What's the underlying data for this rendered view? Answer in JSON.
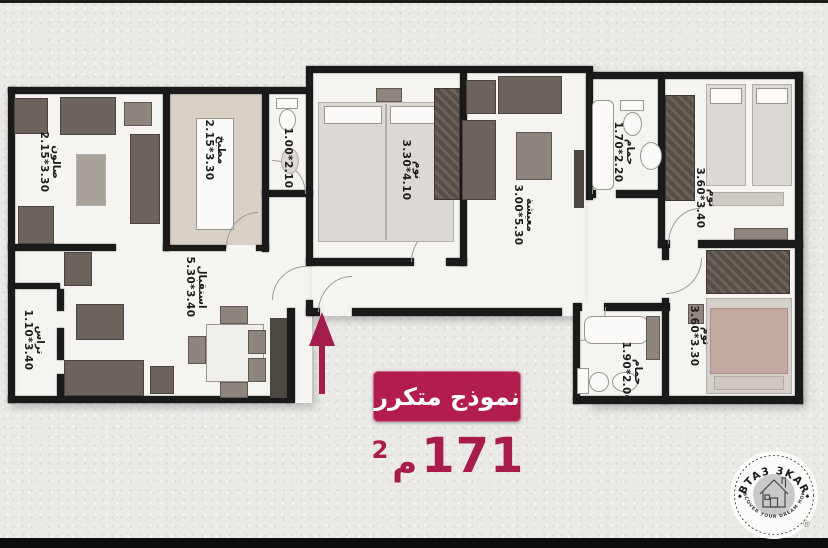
{
  "stamp": {
    "title": "نموذج متكرر",
    "area_value": "171",
    "area_unit": "م",
    "area_exp": "2"
  },
  "logo": {
    "brand": "BTA3 3KAR",
    "tagline": "DISCOVER YOUR DREAM HOME",
    "registered": "®"
  },
  "rooms": {
    "salon": {
      "name": "صالون",
      "dims": "2.15*3.30"
    },
    "kitchen": {
      "name": "مطبخ",
      "dims": "2.15*3.30"
    },
    "wc": {
      "name": "",
      "dims": "1.00*2.10"
    },
    "bedroom1": {
      "name": "نوم",
      "dims": "3.30*4.10"
    },
    "living": {
      "name": "معيشة",
      "dims": "3.00*5.30"
    },
    "bath1": {
      "name": "حمام",
      "dims": "1.70*2.20"
    },
    "bedroom2": {
      "name": "نوم",
      "dims": "3.60*3.40"
    },
    "reception": {
      "name": "استقبال",
      "dims": "5.30*3.40"
    },
    "terrace": {
      "name": "تراس",
      "dims": "1.10*3.40"
    },
    "bath2": {
      "name": "حمام",
      "dims": "1.90*2.00"
    },
    "bedroom3": {
      "name": "نوم",
      "dims": "3.60*3.30"
    }
  },
  "colors": {
    "accent": "#b31d4e",
    "wall": "#1a1a1a",
    "floor": "#f5f4f1",
    "kitchen_floor": "#d9d1c5",
    "logo_inner": "#c9c9c9"
  }
}
